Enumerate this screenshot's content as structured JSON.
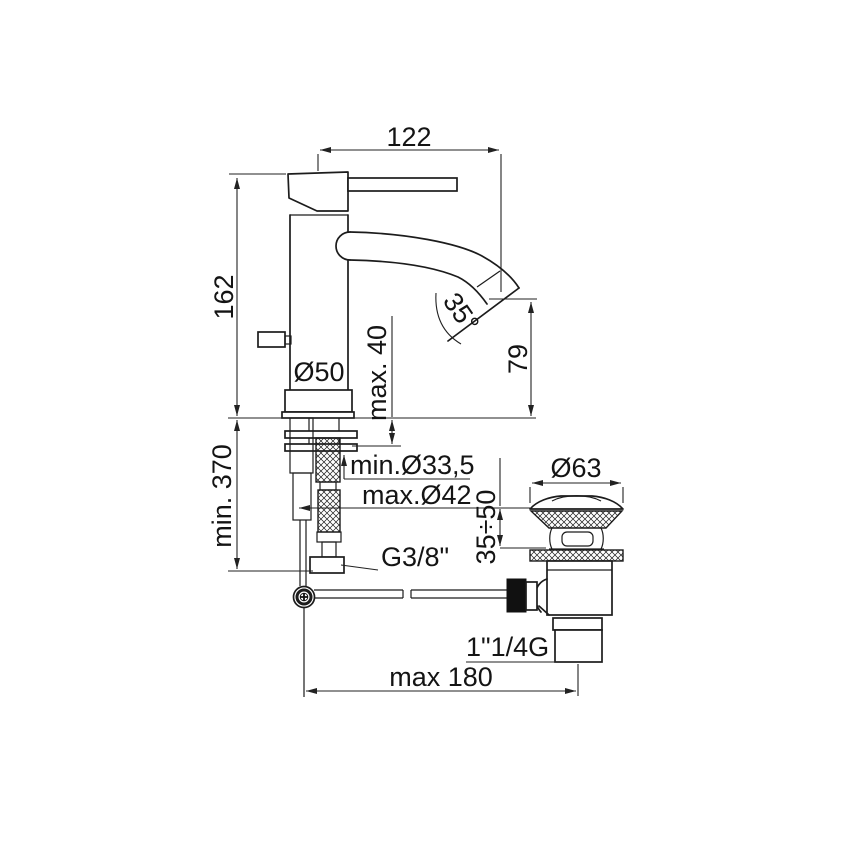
{
  "page": {
    "background": "#ffffff",
    "line_color": "#1c1c1c"
  },
  "drawing": {
    "type": "technical-dimension-drawing",
    "subject": "single-lever basin mixer tap with flexible hoses and pop-up waste",
    "labels": {
      "spout_reach": "122",
      "body_height": "162",
      "spout_angle": "35°",
      "max_counter_thickness": "max. 40",
      "spout_outlet_height": "79",
      "base_diameter": "Ø50",
      "min_hose_length": "min. 370",
      "min_hole_diameter": "min.Ø33,5",
      "max_hole_diameter": "max.Ø42",
      "supply_connection": "G3/8\"",
      "waste_flange_diameter": "Ø63",
      "waste_counter_range": "35÷50",
      "waste_thread": "1\"1/4G",
      "max_rod_reach": "max 180"
    }
  }
}
